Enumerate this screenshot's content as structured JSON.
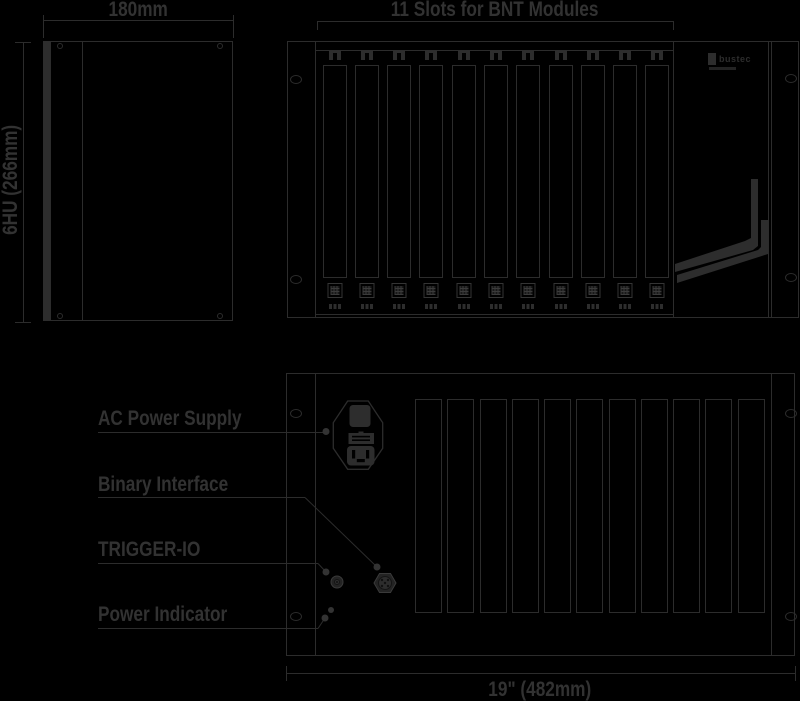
{
  "colors": {
    "background": "#000000",
    "line": "#2c2c2c",
    "text": "#323232",
    "fill": "#2d2d2d"
  },
  "side_view": {
    "width_label": "180mm",
    "height_label": "6HU (266mm)"
  },
  "front_view": {
    "title": "11 Slots for BNT Modules",
    "slot_count": 11,
    "logo_text": "bustec"
  },
  "rear_view": {
    "slot_count": 11,
    "width_label": "19\" (482mm)",
    "callouts": {
      "ac_power": "AC Power Supply",
      "binary_interface": "Binary Interface",
      "trigger_io": "TRIGGER-IO",
      "power_indicator": "Power Indicator"
    }
  }
}
